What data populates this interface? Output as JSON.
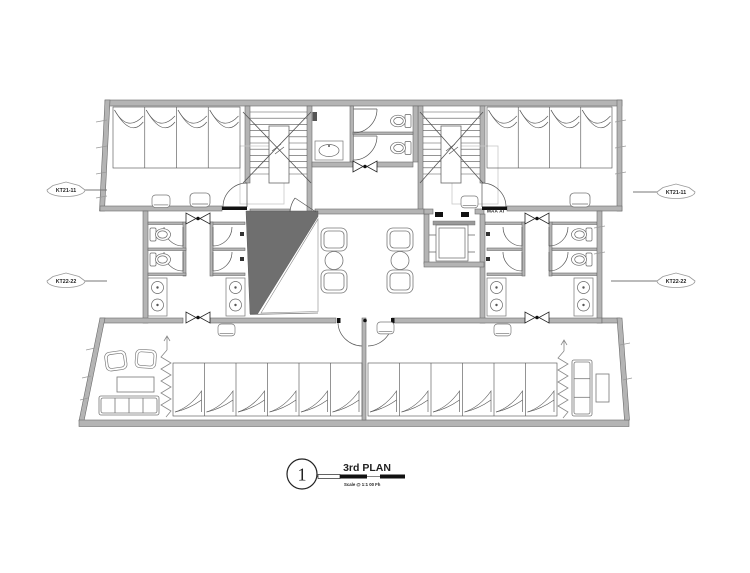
{
  "plan": {
    "markers": {
      "left_top": "KT21-11",
      "left_bottom": "KT22-22",
      "right_top": "KT21-11",
      "right_bottom": "KT22-22"
    },
    "small_label": "MAA AI",
    "title_callout": {
      "number": "1",
      "title": "3rd PLAN",
      "scale_note": "Scale @ 1:1   00 Fh"
    },
    "rooms": {
      "dorm_top_left_beds": 4,
      "dorm_top_right_beds": 4,
      "hall_bottom_left_beds": 6,
      "hall_bottom_right_beds": 6
    },
    "colors": {
      "wall": "#b4b4b4",
      "wall_edge": "#6b6b6b",
      "line": "#555555",
      "dark_wedge": "#6f6f6f",
      "light_guide": "#c9c9c9",
      "black": "#111111"
    }
  }
}
